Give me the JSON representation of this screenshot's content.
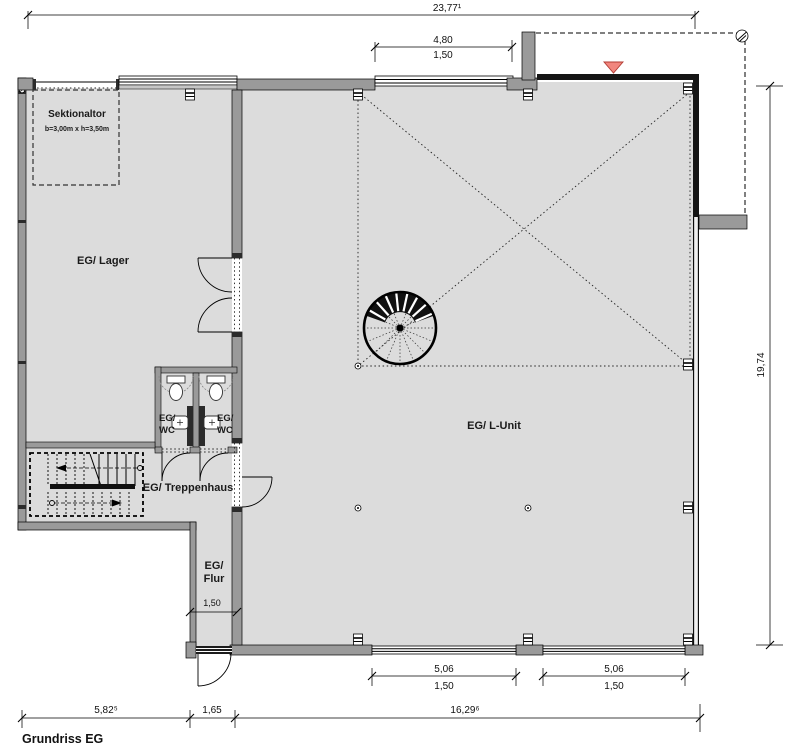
{
  "drawing": {
    "title": "Grundriss EG",
    "rooms": {
      "lager": "EG/ Lager",
      "l_unit": "EG/ L-Unit",
      "treppenhaus": "EG/ Treppenhaus",
      "flur_l1": "EG/",
      "flur_l2": "Flur",
      "wc_left_l1": "EG/",
      "wc_left_l2": "WC",
      "wc_right_l1": "EG/",
      "wc_right_l2": "WC"
    },
    "annotations": {
      "sektionaltor_name": "Sektionaltor",
      "sektionaltor_size": "b=3,00m x h=3,50m"
    },
    "dimensions": {
      "total_width": "23,77¹",
      "top_window_w": "4,80",
      "top_window_sub": "1,50",
      "right_height": "19,74",
      "flur_width": "1,50",
      "bottom_win1_w": "5,06",
      "bottom_win1_sub": "1,50",
      "bottom_win2_w": "5,06",
      "bottom_win2_sub": "1,50",
      "seg_left": "5,82⁵",
      "seg_mid": "1,65",
      "seg_right": "16,29⁶"
    },
    "colors": {
      "floor": "#dcdcdc",
      "wall": "#9a9a9a",
      "entrance_marker": "#f1867e"
    }
  }
}
